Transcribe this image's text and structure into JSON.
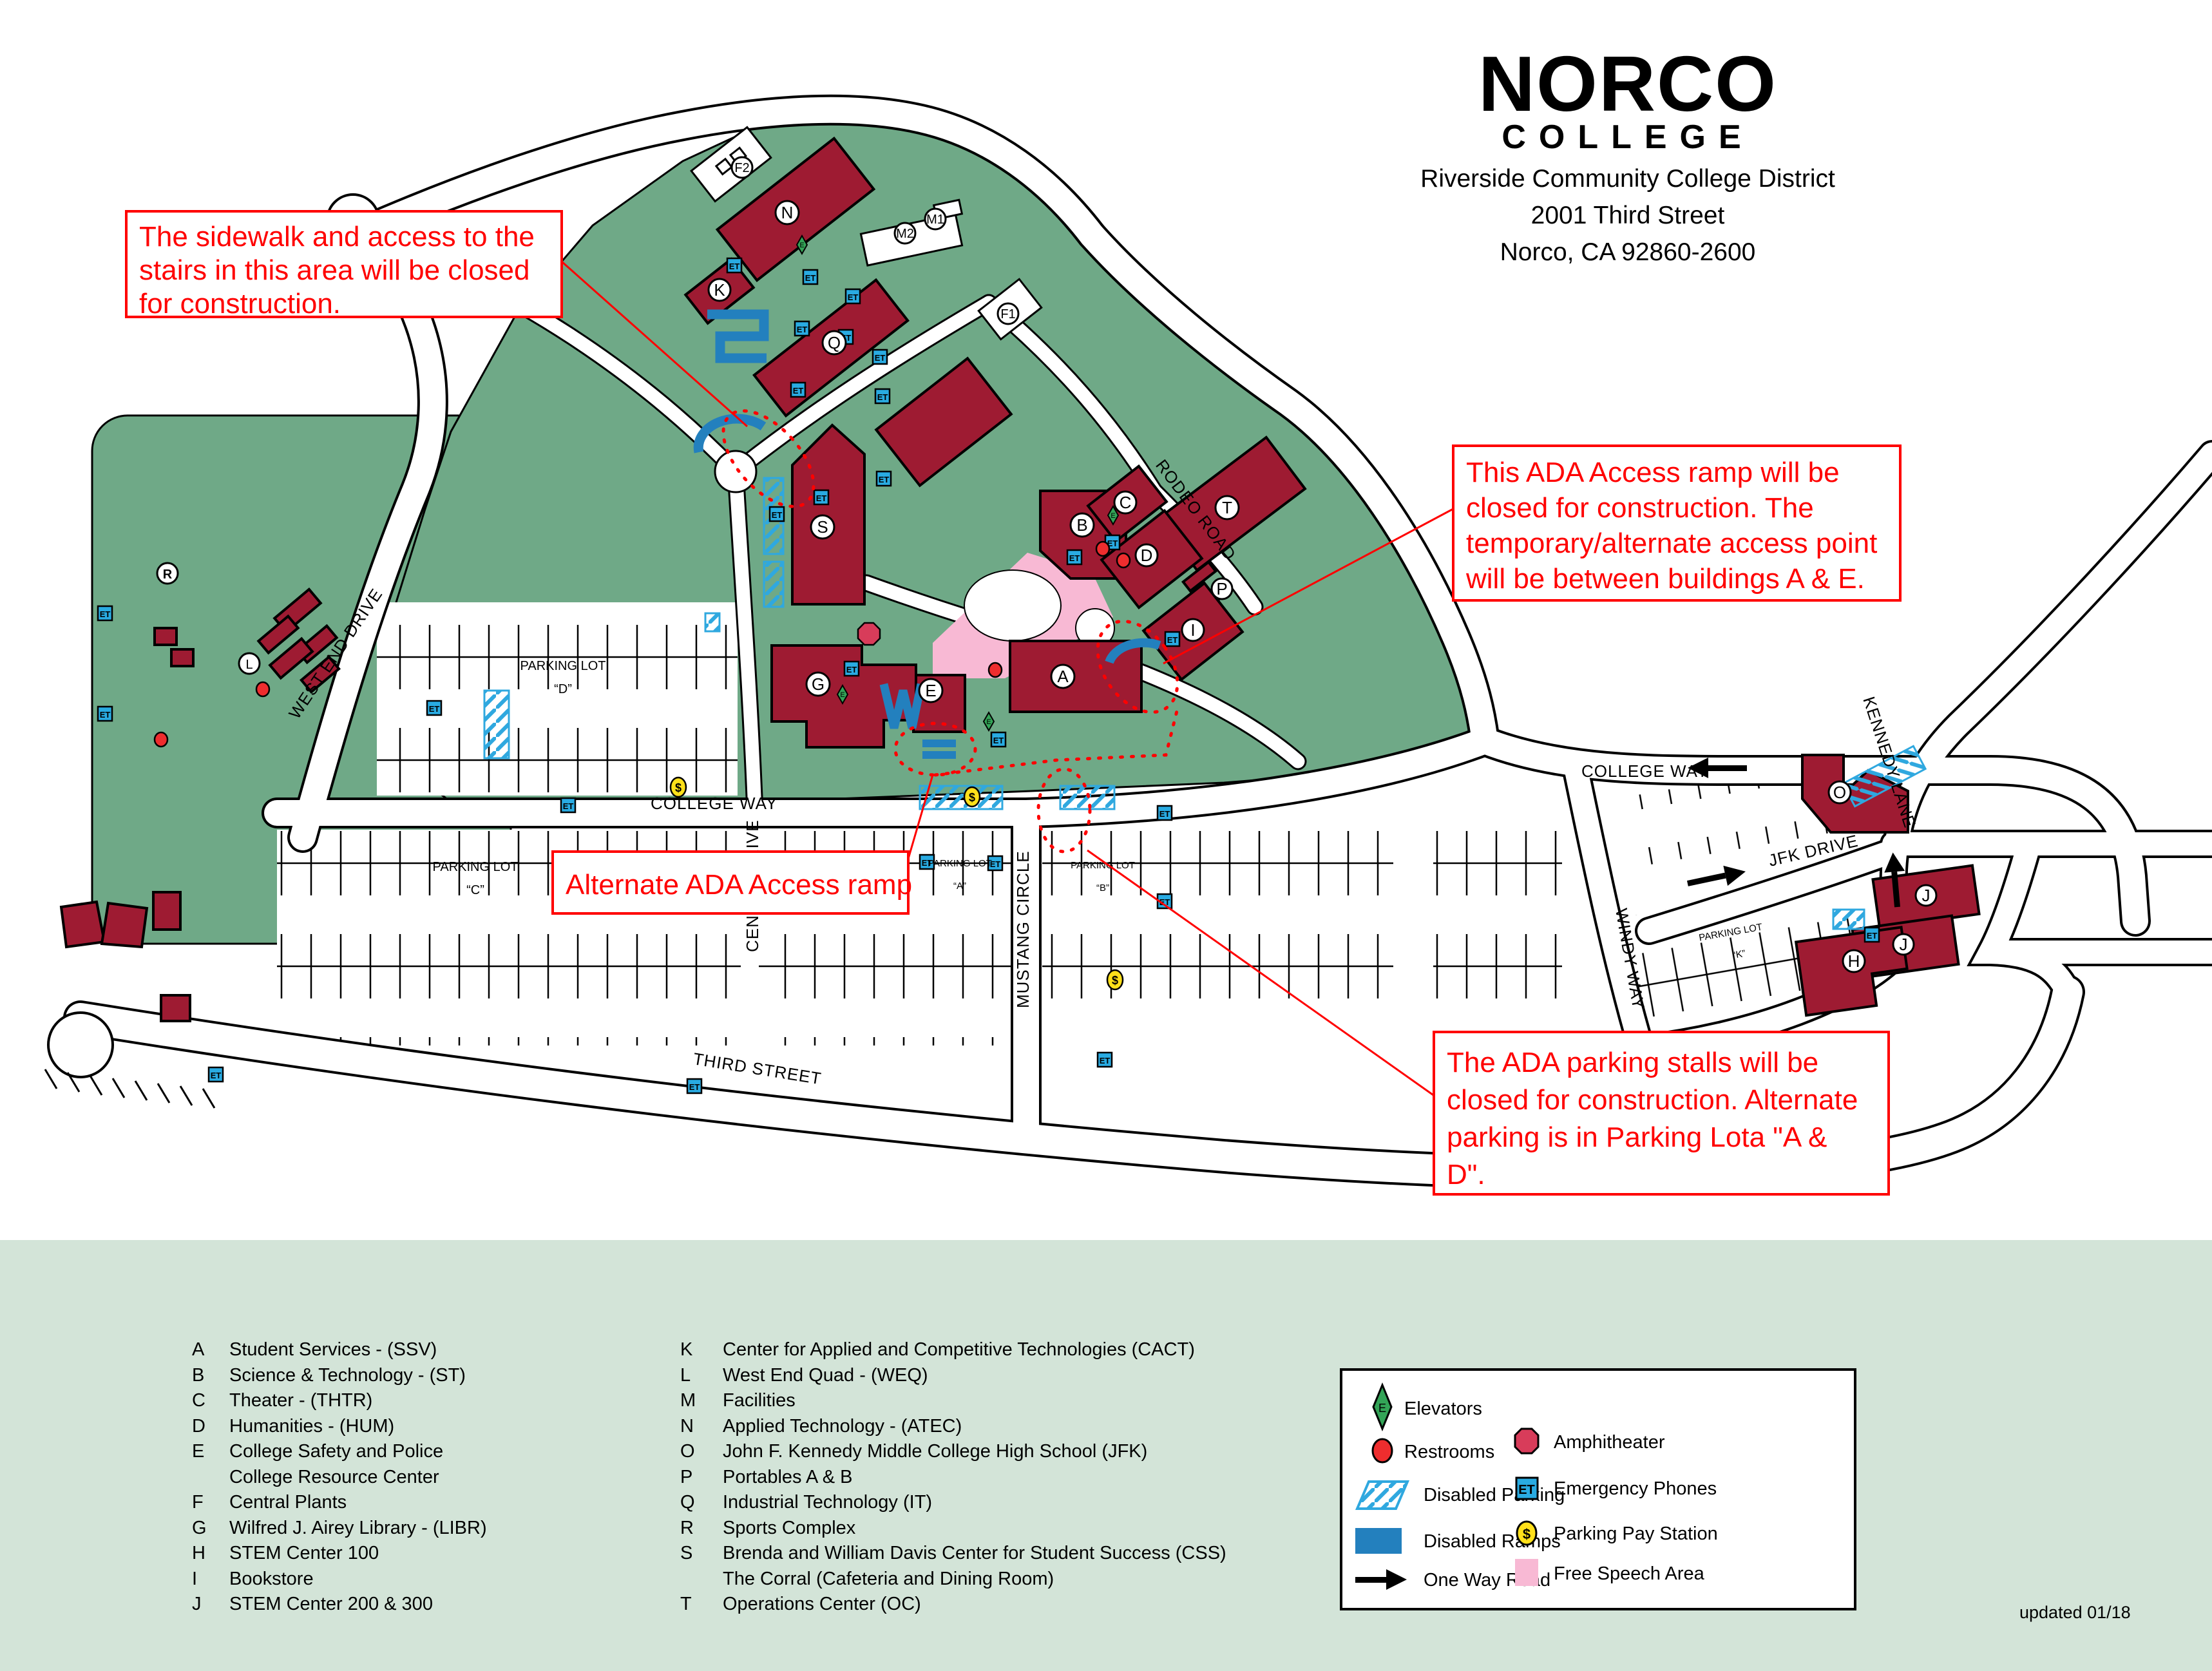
{
  "logo": {
    "name": "NORCO",
    "word": "COLLEGE",
    "address": [
      "Riverside Community College District",
      "2001 Third Street",
      "Norco, CA 92860-2600"
    ]
  },
  "annotations": {
    "box1": {
      "lines": [
        "The sidewalk and access to the",
        "stairs in this area will be closed",
        "for construction."
      ]
    },
    "box2": {
      "lines": [
        "This ADA Access ramp will be",
        "closed for construction. The",
        "temporary/alternate access point",
        "will be between buildings A & E."
      ]
    },
    "box3": {
      "lines": [
        "Alternate ADA Access ramp"
      ]
    },
    "box4": {
      "lines": [
        "The ADA parking stalls will be",
        "closed for construction. Alternate",
        "parking is in Parking Lota \"A &",
        "D\"."
      ]
    }
  },
  "streets": {
    "west_end": "WEST END DRIVE",
    "college_way": "COLLEGE WAY",
    "mustang": "MUSTANG CIRCLE",
    "third": "THIRD STREET",
    "rodeo": "RODEO ROAD",
    "kennedy": "KENNEDY LANE",
    "jfk": "JFK DRIVE",
    "windy": "WINDY WAY",
    "center": "CENTER DRIVE"
  },
  "lots": {
    "title": "PARKING LOT",
    "a": "“A”",
    "b": "“B”",
    "c": "“C”",
    "d": "“D”",
    "k": "“K”"
  },
  "markers": {
    "a": "A",
    "b": "B",
    "c": "C",
    "d": "D",
    "e": "E",
    "f1": "F1",
    "f2": "F2",
    "g": "G",
    "h": "H",
    "i": "I",
    "j": "J",
    "k": "K",
    "l": "L",
    "m1": "M1",
    "m2": "M2",
    "n": "N",
    "o": "O",
    "p": "P",
    "q": "Q",
    "r": "R",
    "s": "S",
    "t": "T"
  },
  "icons": {
    "et": "ET",
    "elevator": "E",
    "pay": "$"
  },
  "legend": {
    "left": [
      "Elevators",
      "Restrooms",
      "Disabled Parking",
      "Disabled Ramps",
      "One Way Road"
    ],
    "right": [
      "Amphitheater",
      "Emergency Phones",
      "Parking Pay Station",
      "Free Speech Area"
    ]
  },
  "list": {
    "left": [
      {
        "letter": "A",
        "name": "Student Services - (SSV)"
      },
      {
        "letter": "B",
        "name": "Science & Technology - (ST)"
      },
      {
        "letter": "C",
        "name": "Theater - (THTR)"
      },
      {
        "letter": "D",
        "name": "Humanities - (HUM)"
      },
      {
        "letter": "E",
        "name": "College Safety and Police"
      },
      {
        "letter": "",
        "name": "College Resource Center"
      },
      {
        "letter": "F",
        "name": "Central Plants"
      },
      {
        "letter": "G",
        "name": "Wilfred J. Airey Library - (LIBR)"
      },
      {
        "letter": "H",
        "name": "STEM Center 100"
      },
      {
        "letter": "I",
        "name": "Bookstore"
      },
      {
        "letter": "J",
        "name": "STEM Center 200 & 300"
      }
    ],
    "right": [
      {
        "letter": "K",
        "name": "Center for Applied and Competitive Technologies (CACT)"
      },
      {
        "letter": "L",
        "name": "West End Quad - (WEQ)"
      },
      {
        "letter": "M",
        "name": "Facilities"
      },
      {
        "letter": "N",
        "name": "Applied Technology - (ATEC)"
      },
      {
        "letter": "O",
        "name": "John F. Kennedy Middle College High School (JFK)"
      },
      {
        "letter": "P",
        "name": "Portables A & B"
      },
      {
        "letter": "Q",
        "name": "Industrial Technology (IT)"
      },
      {
        "letter": "R",
        "name": "Sports Complex"
      },
      {
        "letter": "S",
        "name": "Brenda and William Davis Center for Student Success (CSS)"
      },
      {
        "letter": "",
        "name": "The Corral (Cafeteria and Dining Room)"
      },
      {
        "letter": "T",
        "name": "Operations Center (OC)"
      }
    ]
  },
  "footer": {
    "updated": "updated 01/18"
  }
}
